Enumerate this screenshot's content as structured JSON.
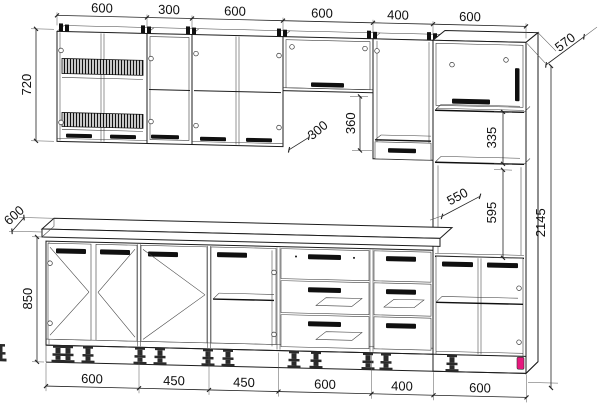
{
  "drawing": {
    "title": "kitchen-cabinet-set-technical-drawing",
    "units": "mm",
    "colors": {
      "line": "#1c1c1c",
      "accent": "#e6187d",
      "background": "#ffffff"
    },
    "dimensions": {
      "top_chain": [
        "600",
        "300",
        "600",
        "600",
        "400",
        "600"
      ],
      "bottom_chain": [
        "600",
        "450",
        "450",
        "600",
        "400",
        "600"
      ],
      "left": {
        "wall_cabinet_height": "720",
        "countertop_depth": "600",
        "base_cabinet_height": "850"
      },
      "right": {
        "tall_cabinet_depth": "570",
        "total_height": "2145"
      },
      "middle": {
        "wall_cabinet_depth": "300",
        "niche_below_top_cabinet": "360",
        "tall_upper_niche_height": "335",
        "tall_niche_depth": "550",
        "oven_niche_height": "595"
      }
    }
  }
}
